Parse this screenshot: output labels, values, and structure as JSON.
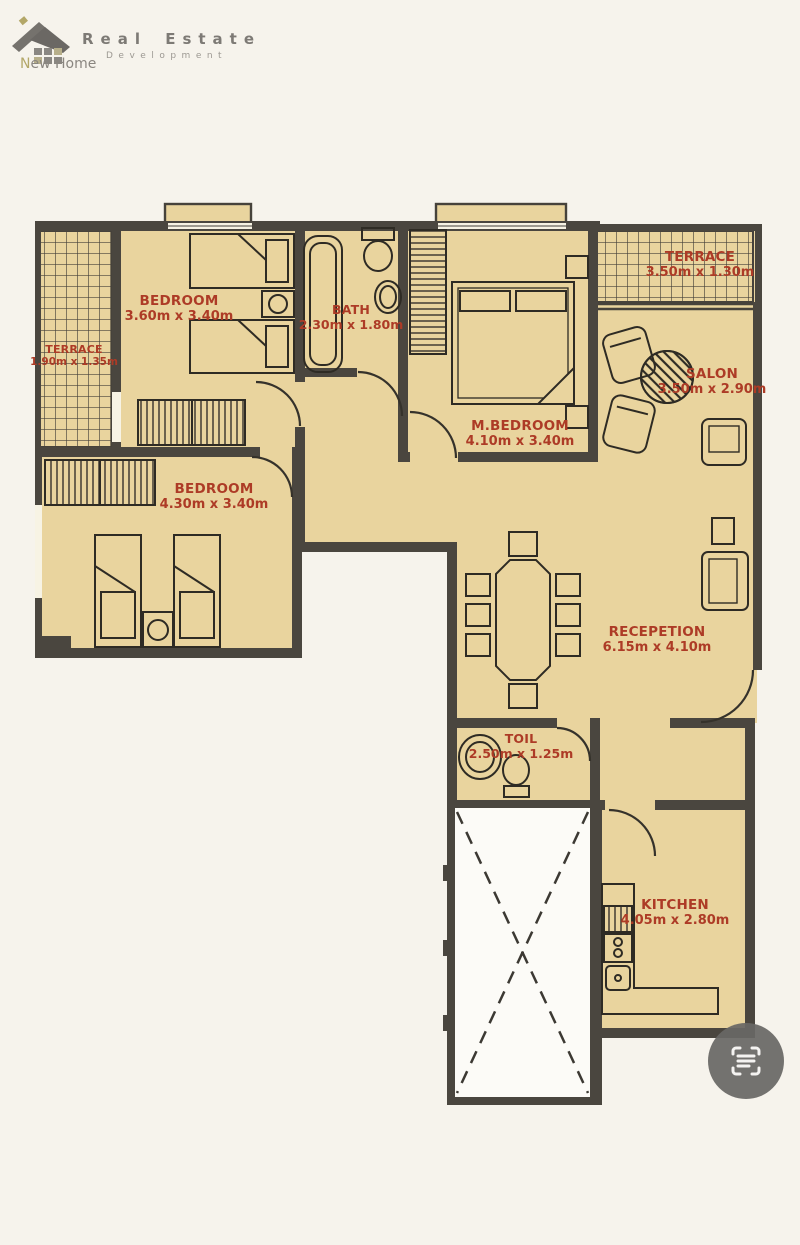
{
  "page": {
    "background": "#f6f3ec"
  },
  "logo": {
    "icon": "house-icon",
    "brand_line1": "Real Estate",
    "brand_line2": "Development",
    "tagline": "New Home"
  },
  "floor_plan": {
    "wall_color": "#4a463f",
    "floor_color": "#e9d49e",
    "label_color": "#ad3b26",
    "rooms": [
      {
        "id": "terrace_left",
        "name": "TERRACE",
        "dimensions": "1.90m x 1.35m"
      },
      {
        "id": "bedroom_top",
        "name": "BEDROOM",
        "dimensions": "3.60m x 3.40m"
      },
      {
        "id": "bath",
        "name": "BATH",
        "dimensions": "2.30m x 1.80m"
      },
      {
        "id": "master_bedroom",
        "name": "M.BEDROOM",
        "dimensions": "4.10m x 3.40m"
      },
      {
        "id": "terrace_right",
        "name": "TERRACE",
        "dimensions": "3.50m x 1.30m"
      },
      {
        "id": "salon",
        "name": "SALON",
        "dimensions": "3.50m x 2.90m"
      },
      {
        "id": "bedroom_left",
        "name": "BEDROOM",
        "dimensions": "4.30m x 3.40m"
      },
      {
        "id": "reception",
        "name": "RECEPETION",
        "dimensions": "6.15m x 4.10m"
      },
      {
        "id": "toilet",
        "name": "TOIL",
        "dimensions": "2.50m x 1.25m"
      },
      {
        "id": "kitchen",
        "name": "KITCHEN",
        "dimensions": "4.05m x 2.80m"
      }
    ]
  },
  "scan_button": {
    "icon": "scan-icon",
    "color": "#6f6e6c"
  }
}
